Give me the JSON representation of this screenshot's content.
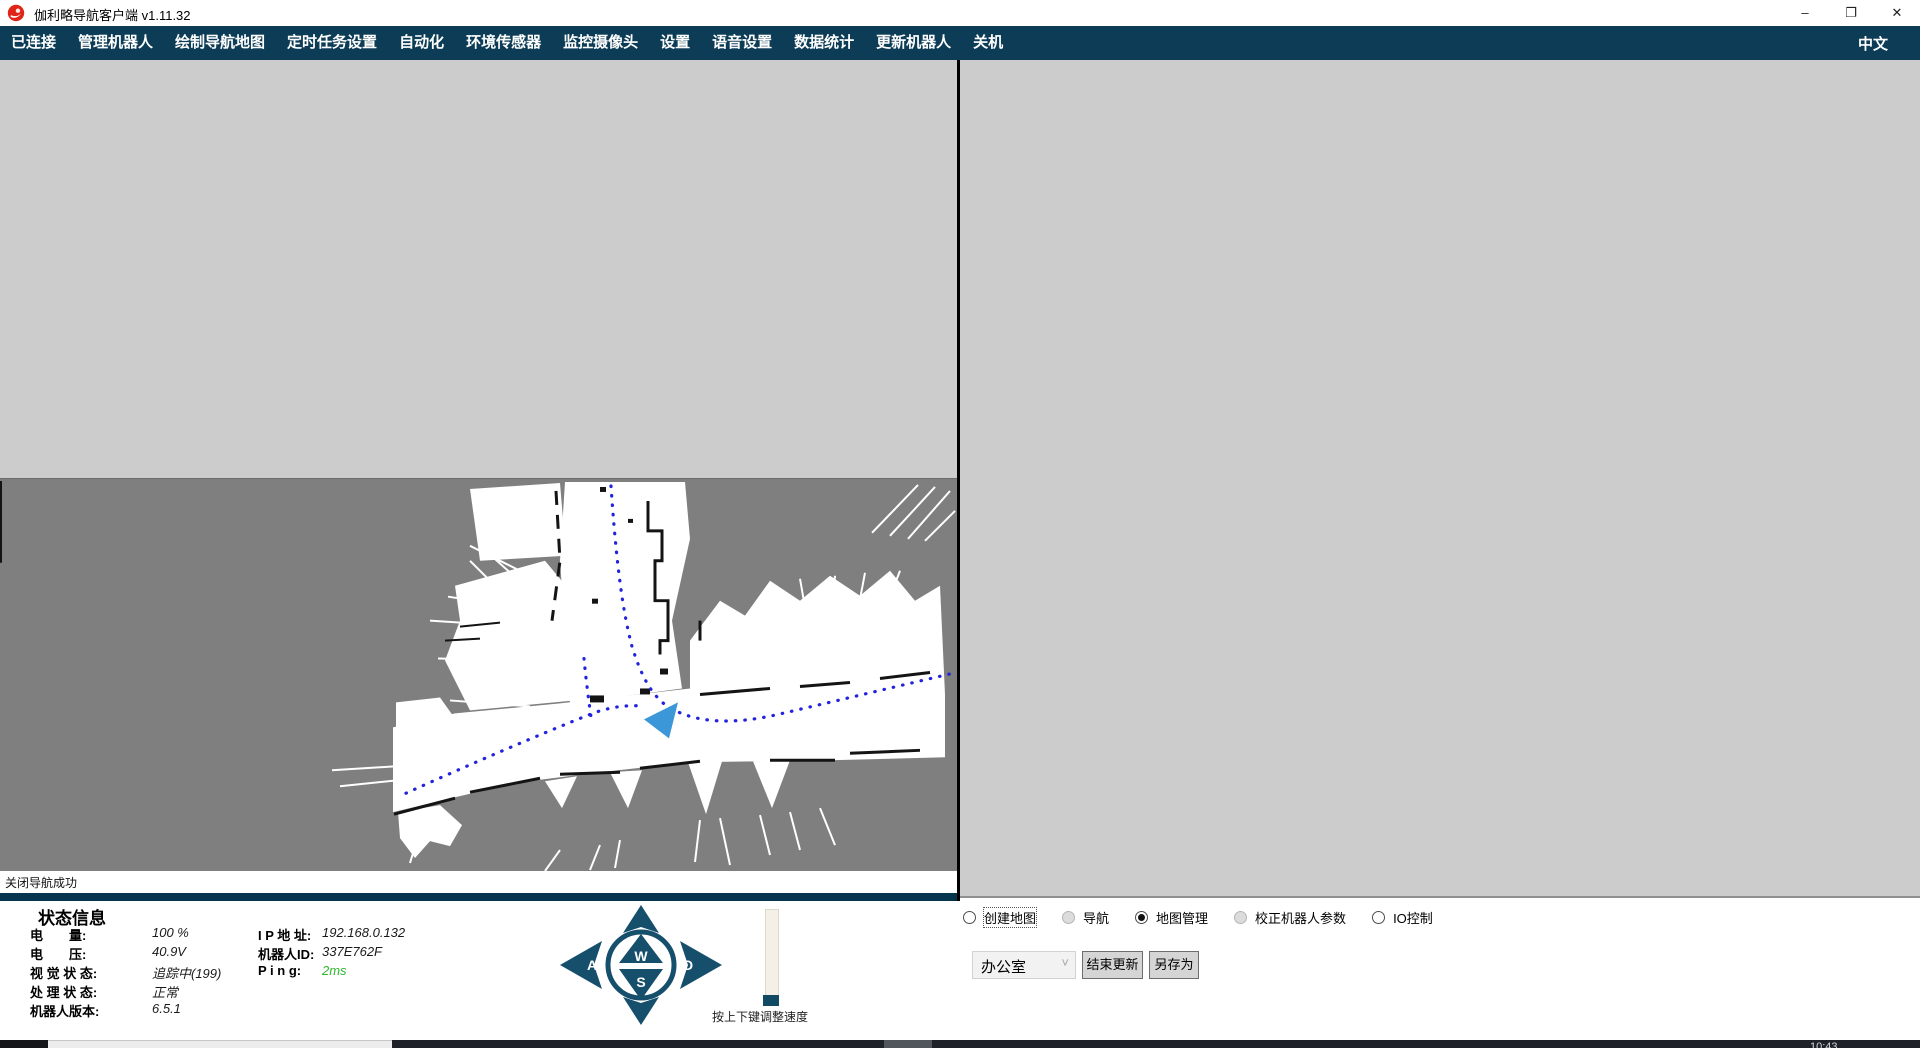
{
  "window": {
    "title": "伽利略导航客户端 v1.11.32"
  },
  "icons": {
    "minimize": "–",
    "restore": "❐",
    "close": "✕",
    "dropdown_chevron": "˅"
  },
  "menu": {
    "items": [
      "已连接",
      "管理机器人",
      "绘制导航地图",
      "定时任务设置",
      "自动化",
      "环境传感器",
      "监控摄像头",
      "设置",
      "语音设置",
      "数据统计",
      "更新机器人",
      "关机"
    ],
    "language": "中文"
  },
  "map_view": {
    "status_message": "关闭导航成功"
  },
  "status_panel": {
    "title": "状态信息",
    "left_rows": [
      {
        "label": "电　　量:",
        "value": "100 %"
      },
      {
        "label": "电　　压:",
        "value": "40.9V"
      },
      {
        "label": "视 觉 状 态:",
        "value": "追踪中(199)"
      },
      {
        "label": "处 理 状 态:",
        "value": "正常"
      },
      {
        "label": "机器人版本:",
        "value": "6.5.1"
      }
    ],
    "right_rows": [
      {
        "label": "I P  地 址:",
        "value": "192.168.0.132"
      },
      {
        "label": "机器人ID:",
        "value": "337E762F"
      },
      {
        "label": "P i n g:",
        "value": "2ms"
      }
    ]
  },
  "teleop": {
    "key_up": "W",
    "key_left": "A",
    "key_down": "S",
    "key_right": "D",
    "slider_hint": "按上下键调整速度"
  },
  "modes": {
    "selected": "地图管理",
    "options": [
      {
        "label": "创建地图"
      },
      {
        "label": "导航"
      },
      {
        "label": "地图管理"
      },
      {
        "label": "校正机器人参数"
      },
      {
        "label": "IO控制"
      }
    ]
  },
  "map_manager": {
    "current_map": "办公室",
    "finish_update_button": "结束更新",
    "save_as_button": "另存为"
  },
  "taskbar": {
    "clock": "10:43"
  },
  "colors": {
    "menubar": "#0d3d56",
    "separator": "#05344e",
    "accent_blue": "#3b97d8",
    "path_blue": "#2323dd",
    "ping_green": "#2eb82e",
    "map_unknown_gray": "#7f7f7f",
    "pane_gray": "#cccccc"
  }
}
